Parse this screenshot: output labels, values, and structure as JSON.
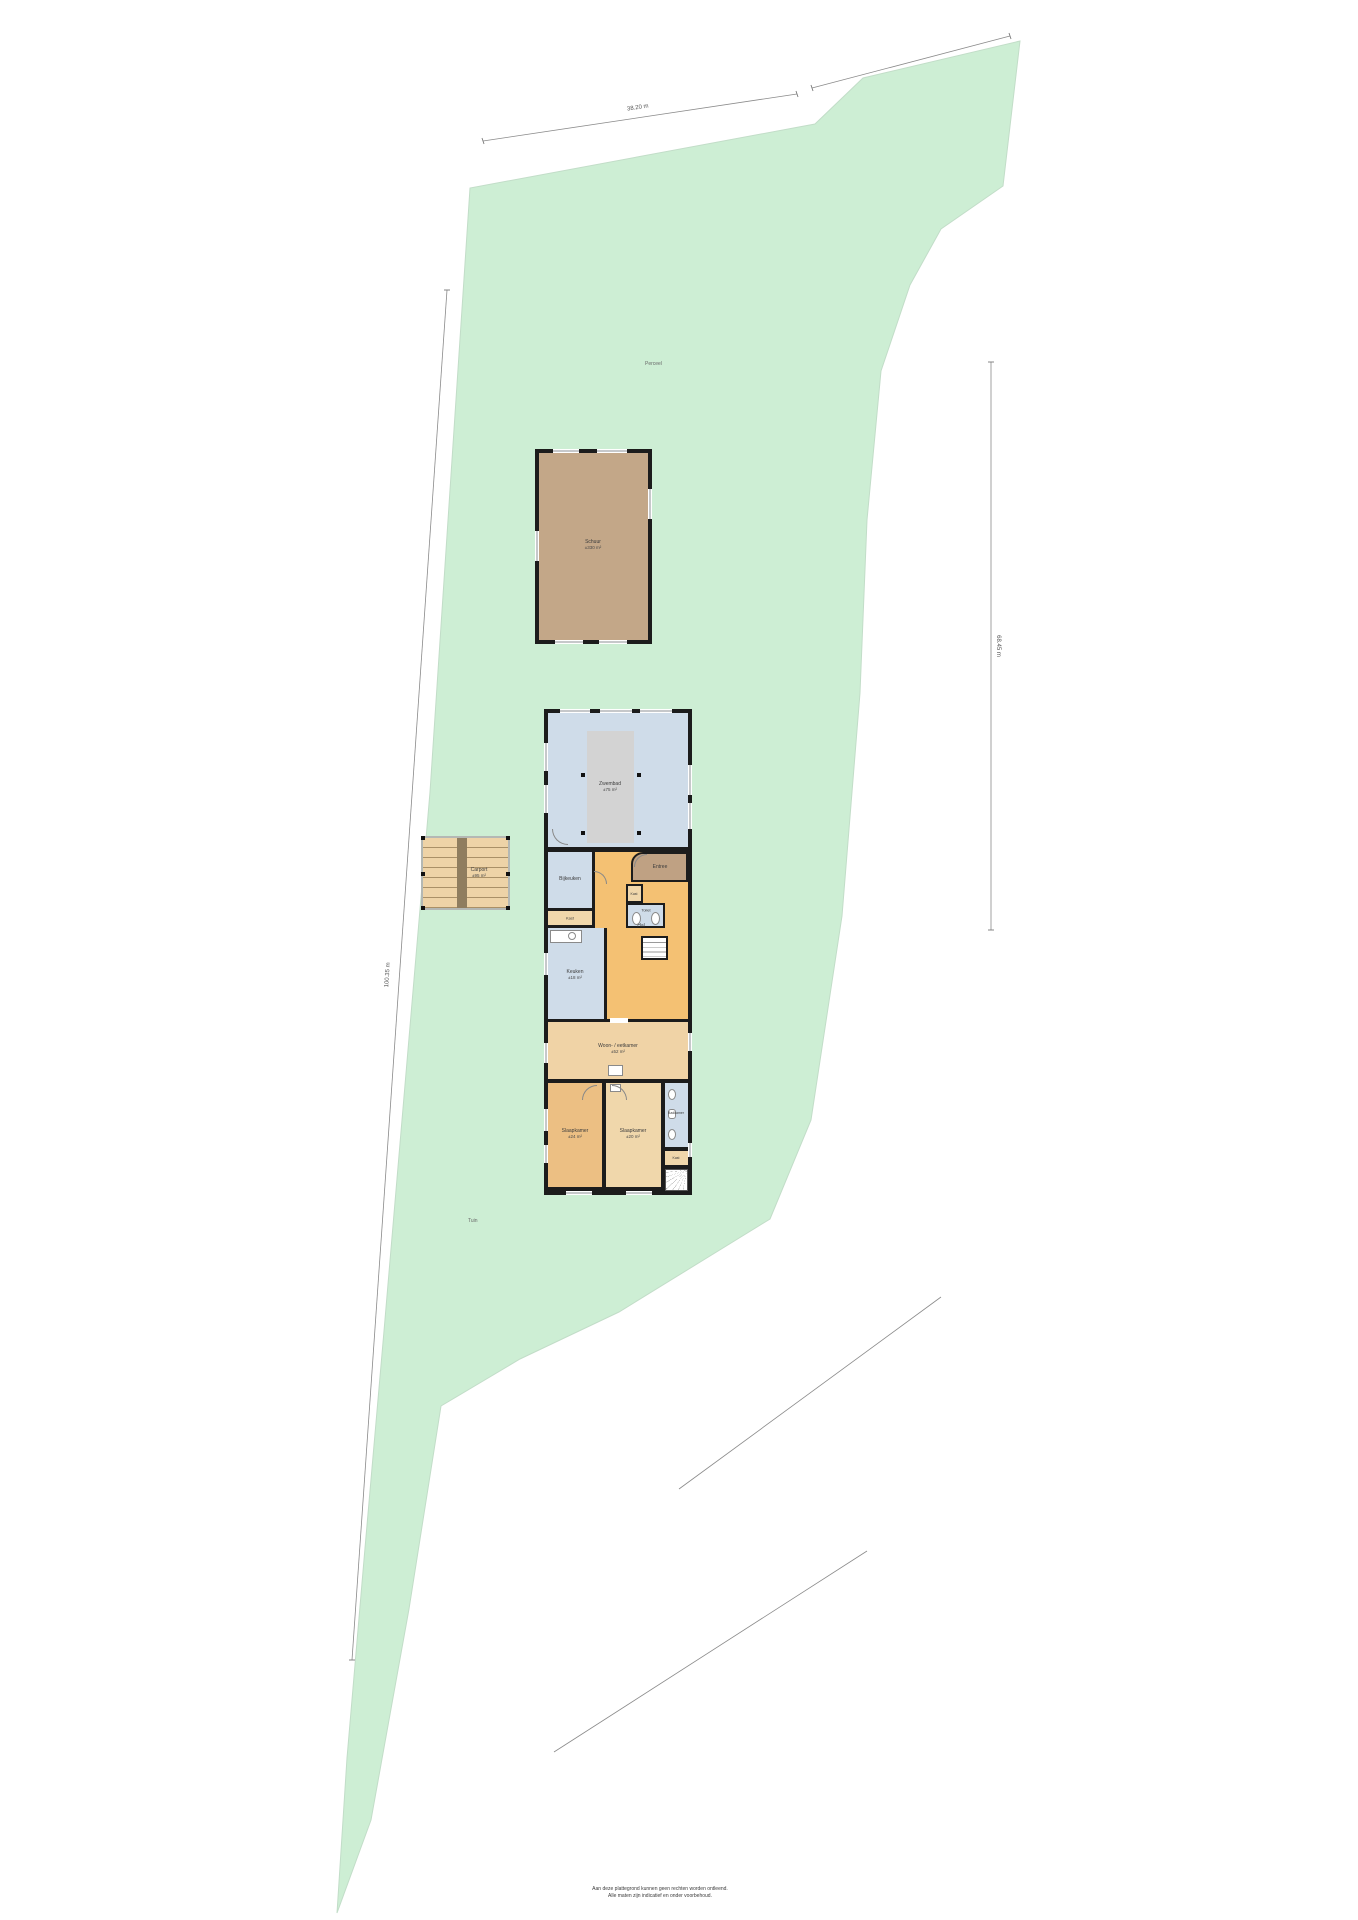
{
  "site": {
    "labels": {
      "field_top": "Perceel",
      "field_bottom": "Tuin"
    },
    "dimensions": {
      "top": "38.20 m",
      "right": "68.45 m",
      "left": "100.35 m"
    },
    "disclaimer": {
      "line1": "Aan deze plattegrond kunnen geen rechten worden ontleend.",
      "line2": "Alle maten zijn indicatief en onder voorbehoud."
    },
    "colors": {
      "grass": "#cdeed4",
      "wall": "#1c1c1c",
      "barn_fill": "#c3a788",
      "wet_room_blue": "#cfdce9",
      "hall_orange": "#f4c173",
      "room_beige": "#f0d3a6",
      "bedroom_orange": "#ecbf83",
      "room_tan": "#f0d7ab",
      "pool_gray": "#d3d3d3"
    }
  },
  "barn": {
    "name": "Schuur",
    "size": "±330 m²"
  },
  "carport": {
    "name": "Carport",
    "size": "±95 m²"
  },
  "house": {
    "rooms": {
      "zwembad": {
        "name": "Zwembad",
        "size": "±75 m²"
      },
      "entree": {
        "name": "Entree"
      },
      "bijkeuken": {
        "name": "Bijkeuken"
      },
      "kast_bijkeuken": {
        "name": "Kast"
      },
      "hal": {
        "name": "Hal"
      },
      "toilet": {
        "name": "Toilet"
      },
      "kast_hal": {
        "name": "Kast"
      },
      "keuken": {
        "name": "Keuken",
        "size": "±18 m²"
      },
      "woonkamer": {
        "name": "Woon- / eetkamer",
        "size": "±52 m²"
      },
      "slaapkamer_links": {
        "name": "Slaapkamer",
        "size": "±24 m²"
      },
      "slaapkamer_midden": {
        "name": "Slaapkamer",
        "size": "±20 m²"
      },
      "badkamer": {
        "name": "Badkamer"
      },
      "kast_overloop": {
        "name": "Kast"
      }
    }
  }
}
